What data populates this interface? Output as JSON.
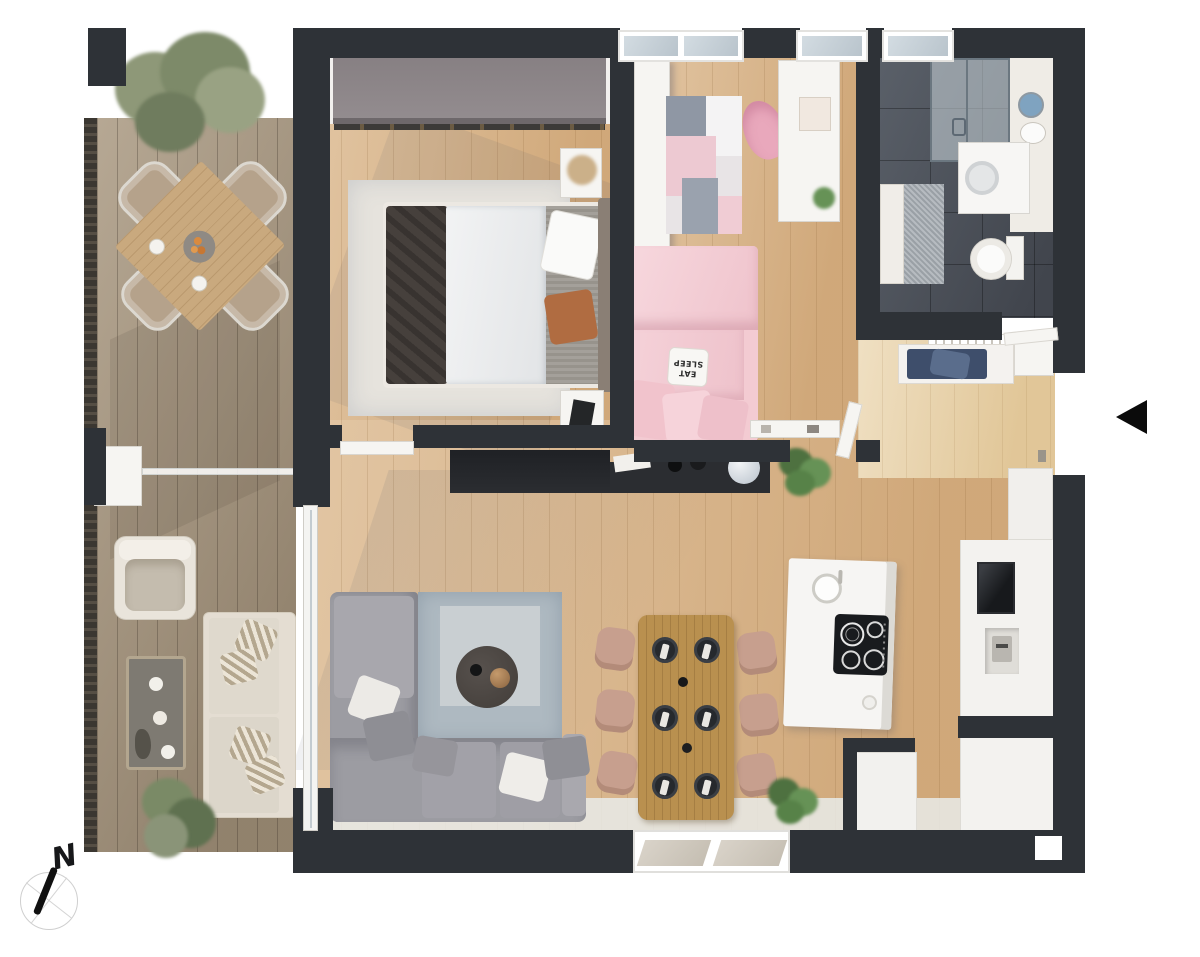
{
  "compass": {
    "icon": "north-compass-icon",
    "label": "N"
  },
  "entrance_marker": {
    "icon": "entrance-arrow-icon",
    "direction": "left"
  },
  "decor_text": {
    "pillow_line1": "EAT",
    "pillow_line2": "SLEEP"
  },
  "palette": {
    "wall": "#2e3237",
    "wood_floor": "#d8b284",
    "hall_floor": "#e7cfa2",
    "terrace_deck": "#a8977f",
    "bathroom_tile": "#4b5058",
    "bedroom_pink": "#f3cbd2",
    "sofa_gray": "#9c9ca2",
    "living_rug": "#aeb9c1",
    "dining_wood": "#b9904f",
    "kitchen_white": "#f6f5f3",
    "sideboard_black": "#26282c",
    "plant_green": "#5f7f4e",
    "bench_cushion_navy": "#3e4e6b",
    "mirror_blue": "#7fa3c0",
    "cooktop_black": "#191b1e"
  }
}
